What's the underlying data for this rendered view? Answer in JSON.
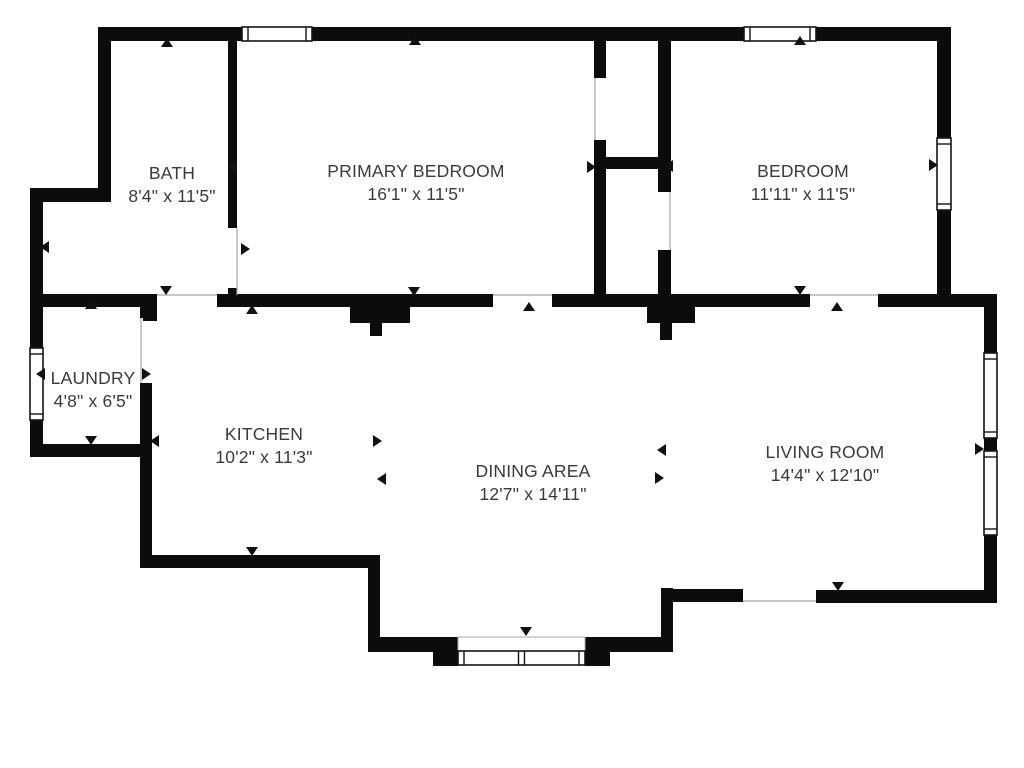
{
  "title": "Residential floor plan",
  "colors": {
    "background": "#ffffff",
    "wall": "#0c0c0c",
    "window_fill": "#ffffff",
    "window_border": "#141414",
    "thin_line": "#a8a8a8",
    "marker": "#111111",
    "text": "#3a3a3a"
  },
  "rooms": [
    {
      "id": "bath",
      "name": "BATH",
      "size": "8'4\" x 11'5\"",
      "label_x": 172,
      "label_top": 162
    },
    {
      "id": "primary",
      "name": "PRIMARY BEDROOM",
      "size": "16'1\" x 11'5\"",
      "label_x": 416,
      "label_top": 160
    },
    {
      "id": "bedroom",
      "name": "BEDROOM",
      "size": "11'11\" x 11'5\"",
      "label_x": 803,
      "label_top": 160
    },
    {
      "id": "laundry",
      "name": "LAUNDRY",
      "size": "4'8\" x 6'5\"",
      "label_x": 93,
      "label_top": 367
    },
    {
      "id": "kitchen",
      "name": "KITCHEN",
      "size": "10'2\" x 11'3\"",
      "label_x": 264,
      "label_top": 423
    },
    {
      "id": "dining",
      "name": "DINING AREA",
      "size": "12'7\" x 14'11\"",
      "label_x": 533,
      "label_top": 460
    },
    {
      "id": "living",
      "name": "LIVING ROOM",
      "size": "14'4\" x 12'10\"",
      "label_x": 825,
      "label_top": 441
    }
  ],
  "plan": {
    "width": 1024,
    "height": 768,
    "walls": [
      {
        "id": "top-wall",
        "x": 98,
        "y": 27,
        "w": 853,
        "h": 14
      },
      {
        "id": "bath-left-upper",
        "x": 98,
        "y": 27,
        "w": 13,
        "h": 174
      },
      {
        "id": "left-step",
        "x": 30,
        "y": 188,
        "w": 81,
        "h": 14
      },
      {
        "id": "left-upper",
        "x": 30,
        "y": 188,
        "w": 13,
        "h": 160
      },
      {
        "id": "left-lower",
        "x": 30,
        "y": 420,
        "w": 13,
        "h": 37
      },
      {
        "id": "laundry-bottom",
        "x": 30,
        "y": 444,
        "w": 122,
        "h": 13
      },
      {
        "id": "kitchen-left",
        "x": 140,
        "y": 444,
        "w": 12,
        "h": 124
      },
      {
        "id": "kitchen-bottom",
        "x": 140,
        "y": 555,
        "w": 240,
        "h": 13
      },
      {
        "id": "dining-step-left",
        "x": 368,
        "y": 555,
        "w": 12,
        "h": 97
      },
      {
        "id": "dining-bottom-left",
        "x": 368,
        "y": 637,
        "w": 90,
        "h": 15
      },
      {
        "id": "bay-block-left",
        "x": 433,
        "y": 637,
        "w": 25,
        "h": 29
      },
      {
        "id": "bay-block-right",
        "x": 585,
        "y": 637,
        "w": 25,
        "h": 29
      },
      {
        "id": "dining-bottom-right",
        "x": 585,
        "y": 637,
        "w": 77,
        "h": 15
      },
      {
        "id": "dining-living-step",
        "x": 661,
        "y": 588,
        "w": 12,
        "h": 64
      },
      {
        "id": "living-bottom-left",
        "x": 661,
        "y": 589,
        "w": 82,
        "h": 13
      },
      {
        "id": "living-bottom-right",
        "x": 816,
        "y": 590,
        "w": 181,
        "h": 13
      },
      {
        "id": "living-right-a",
        "x": 984,
        "y": 300,
        "w": 13,
        "h": 53
      },
      {
        "id": "living-right-b",
        "x": 984,
        "y": 438,
        "w": 13,
        "h": 13
      },
      {
        "id": "living-right-c",
        "x": 984,
        "y": 535,
        "w": 13,
        "h": 68
      },
      {
        "id": "bedroom-right-a",
        "x": 937,
        "y": 27,
        "w": 14,
        "h": 111
      },
      {
        "id": "bedroom-right-b",
        "x": 937,
        "y": 210,
        "w": 14,
        "h": 97
      },
      {
        "id": "divider-a",
        "x": 30,
        "y": 294,
        "w": 127,
        "h": 13
      },
      {
        "id": "divider-a-stub",
        "x": 143,
        "y": 307,
        "w": 14,
        "h": 14
      },
      {
        "id": "divider-b",
        "x": 217,
        "y": 294,
        "w": 276,
        "h": 13
      },
      {
        "id": "divider-b-block",
        "x": 350,
        "y": 307,
        "w": 60,
        "h": 16
      },
      {
        "id": "divider-b-stub",
        "x": 370,
        "y": 323,
        "w": 12,
        "h": 13
      },
      {
        "id": "divider-c",
        "x": 552,
        "y": 294,
        "w": 258,
        "h": 13
      },
      {
        "id": "divider-d",
        "x": 878,
        "y": 294,
        "w": 119,
        "h": 13
      },
      {
        "id": "bath-right",
        "x": 228,
        "y": 41,
        "w": 9,
        "h": 187
      },
      {
        "id": "bath-right-stub",
        "x": 228,
        "y": 288,
        "w": 9,
        "h": 7
      },
      {
        "id": "laundry-right-a",
        "x": 140,
        "y": 294,
        "w": 12,
        "h": 24
      },
      {
        "id": "laundry-right-b",
        "x": 140,
        "y": 383,
        "w": 12,
        "h": 61
      },
      {
        "id": "closet-left-a",
        "x": 594,
        "y": 41,
        "w": 12,
        "h": 37
      },
      {
        "id": "closet-left-b",
        "x": 594,
        "y": 140,
        "w": 12,
        "h": 154
      },
      {
        "id": "closet-right-a",
        "x": 658,
        "y": 41,
        "w": 13,
        "h": 151
      },
      {
        "id": "closet-right-b",
        "x": 658,
        "y": 250,
        "w": 13,
        "h": 44
      },
      {
        "id": "closet-connector",
        "x": 594,
        "y": 157,
        "w": 77,
        "h": 12
      },
      {
        "id": "junction-block",
        "x": 647,
        "y": 305,
        "w": 48,
        "h": 18
      },
      {
        "id": "junction-stub",
        "x": 660,
        "y": 323,
        "w": 12,
        "h": 17
      }
    ],
    "windows": [
      {
        "id": "bath-top-window",
        "x": 242,
        "y": 27,
        "w": 70,
        "h": 14,
        "o": "h"
      },
      {
        "id": "bedroom-top-window",
        "x": 744,
        "y": 27,
        "w": 72,
        "h": 14,
        "o": "h"
      },
      {
        "id": "bedroom-right-window",
        "x": 937,
        "y": 138,
        "w": 14,
        "h": 72,
        "o": "v"
      },
      {
        "id": "living-window-1",
        "x": 984,
        "y": 353,
        "w": 13,
        "h": 85,
        "o": "v"
      },
      {
        "id": "living-window-2",
        "x": 984,
        "y": 451,
        "w": 13,
        "h": 84,
        "o": "v"
      },
      {
        "id": "laundry-window",
        "x": 30,
        "y": 348,
        "w": 13,
        "h": 72,
        "o": "v"
      },
      {
        "id": "bay-window",
        "x": 458,
        "y": 651,
        "w": 127,
        "h": 14,
        "o": "h",
        "double": true
      }
    ],
    "bay_opening": {
      "x": 458,
      "y": 637,
      "w": 127,
      "h": 14
    },
    "door_lines": [
      {
        "id": "bath-door-line",
        "x1": 237,
        "y1": 228,
        "x2": 237,
        "y2": 295
      },
      {
        "id": "bath-kitchen-door-line",
        "x1": 157,
        "y1": 295,
        "x2": 217,
        "y2": 295
      },
      {
        "id": "laundry-door-line",
        "x1": 141,
        "y1": 318,
        "x2": 141,
        "y2": 383
      },
      {
        "id": "primary-door-line",
        "x1": 493,
        "y1": 295,
        "x2": 552,
        "y2": 295
      },
      {
        "id": "bedroom-door-line",
        "x1": 810,
        "y1": 295,
        "x2": 878,
        "y2": 295
      },
      {
        "id": "closet-left-door-line",
        "x1": 595,
        "y1": 78,
        "x2": 595,
        "y2": 140
      },
      {
        "id": "closet-right-door-line",
        "x1": 670,
        "y1": 192,
        "x2": 670,
        "y2": 250
      },
      {
        "id": "living-rear-opening-line",
        "x1": 743,
        "y1": 601,
        "x2": 816,
        "y2": 601
      }
    ],
    "markers": [
      {
        "x": 167,
        "y": 43,
        "dir": "u"
      },
      {
        "x": 166,
        "y": 290,
        "dir": "d"
      },
      {
        "x": 45,
        "y": 247,
        "dir": "l"
      },
      {
        "x": 245,
        "y": 249,
        "dir": "r"
      },
      {
        "x": 415,
        "y": 41,
        "dir": "u"
      },
      {
        "x": 414,
        "y": 291,
        "dir": "d"
      },
      {
        "x": 233,
        "y": 167,
        "dir": "l"
      },
      {
        "x": 591,
        "y": 167,
        "dir": "r"
      },
      {
        "x": 800,
        "y": 41,
        "dir": "u"
      },
      {
        "x": 800,
        "y": 290,
        "dir": "d"
      },
      {
        "x": 669,
        "y": 166,
        "dir": "l"
      },
      {
        "x": 933,
        "y": 165,
        "dir": "r"
      },
      {
        "x": 91,
        "y": 305,
        "dir": "u"
      },
      {
        "x": 91,
        "y": 440,
        "dir": "d"
      },
      {
        "x": 41,
        "y": 374,
        "dir": "l"
      },
      {
        "x": 146,
        "y": 374,
        "dir": "r"
      },
      {
        "x": 252,
        "y": 310,
        "dir": "u"
      },
      {
        "x": 252,
        "y": 551,
        "dir": "d"
      },
      {
        "x": 155,
        "y": 441,
        "dir": "l"
      },
      {
        "x": 377,
        "y": 441,
        "dir": "r"
      },
      {
        "x": 382,
        "y": 479,
        "dir": "l"
      },
      {
        "x": 659,
        "y": 478,
        "dir": "r"
      },
      {
        "x": 529,
        "y": 307,
        "dir": "u"
      },
      {
        "x": 526,
        "y": 631,
        "dir": "d"
      },
      {
        "x": 662,
        "y": 450,
        "dir": "l"
      },
      {
        "x": 979,
        "y": 449,
        "dir": "r"
      },
      {
        "x": 837,
        "y": 307,
        "dir": "u"
      },
      {
        "x": 838,
        "y": 586,
        "dir": "d"
      }
    ]
  }
}
